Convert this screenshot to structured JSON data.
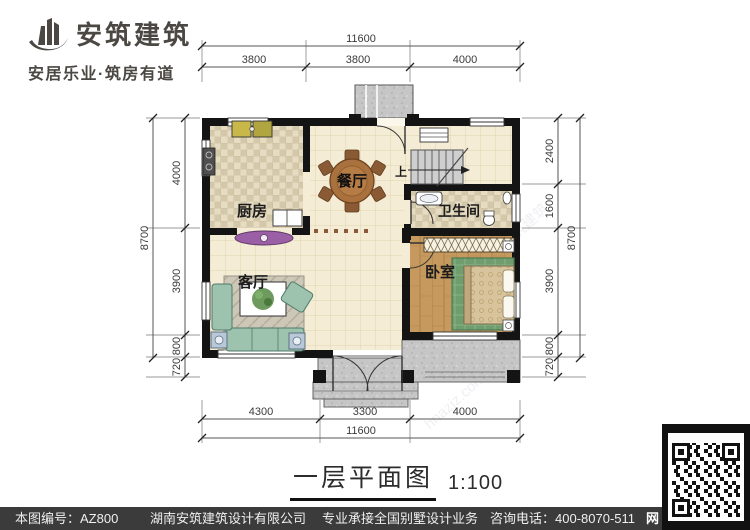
{
  "logo": {
    "name": "安筑建筑",
    "tagline": "安居乐业·筑房有道"
  },
  "title": {
    "text": "一层平面图",
    "scale": "1:100"
  },
  "rooms": {
    "kitchen": "厨房",
    "dining": "餐厅",
    "bathroom": "卫生间",
    "living": "客厅",
    "bedroom": "卧室",
    "stairs_up": "上"
  },
  "dimensions": {
    "top": {
      "total": "11600",
      "segments": [
        "3800",
        "3800",
        "4000"
      ]
    },
    "bottom": {
      "total": "11600",
      "segments": [
        "4300",
        "3300",
        "4000"
      ]
    },
    "left": {
      "total": "8700",
      "segments": [
        "4000",
        "3900",
        "800",
        "720"
      ]
    },
    "right": {
      "total": "8700",
      "segments": [
        "2400",
        "1600",
        "3900",
        "800",
        "720"
      ]
    }
  },
  "footer": {
    "drawing_number": "本图编号：AZ800",
    "company": "湖南安筑建筑设计有限公司",
    "service": "专业承接全国别墅设计业务",
    "phone": "咨询电话：400-8070-511",
    "web_badge": "网"
  },
  "watermark": {
    "site": "hnazjz.com",
    "brand": "安筑建筑"
  },
  "colors": {
    "wall": "#141414",
    "floor_beige": "#f4ecd4",
    "tile": "#ddd3b8",
    "wood": "#c69a5f",
    "porch": "#c6c6c6",
    "accent_purple": "#9a5fa5",
    "rug_green": "#6f9d6e",
    "sofa_teal": "#9dc3af",
    "footer_bg": "#3b3b3b"
  }
}
